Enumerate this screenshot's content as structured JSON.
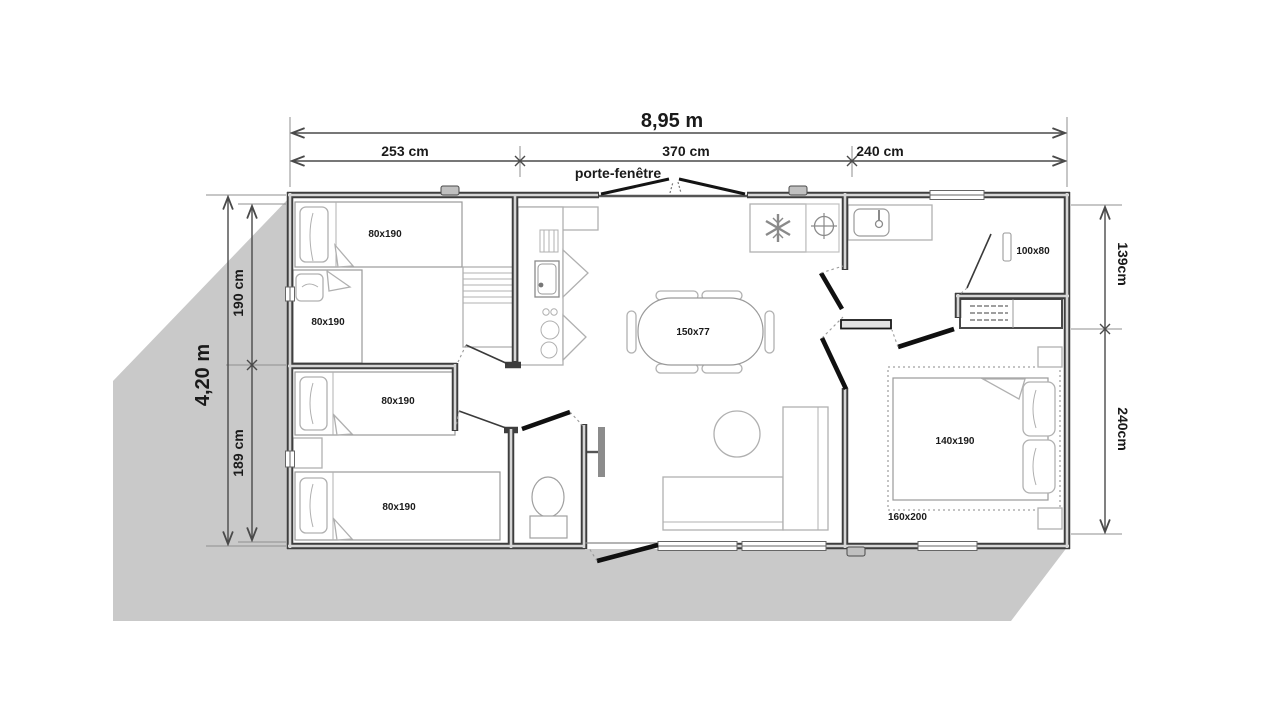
{
  "dimensions": {
    "total_width": "8,95 m",
    "top_segments": [
      "253 cm",
      "370 cm",
      "240 cm"
    ],
    "door_label": "porte-fenêtre",
    "total_depth": "4,20 m",
    "left_segments": [
      "190 cm",
      "189 cm"
    ],
    "right_segments": [
      "139cm",
      "240cm"
    ]
  },
  "rooms": {
    "bed_labels": [
      "80x190",
      "80x190",
      "80x190",
      "80x190"
    ],
    "dining_table": "150x77",
    "shower": "100x80",
    "double_bed": "140x190",
    "double_bed_zone": "160x200"
  },
  "colors": {
    "shadow": "#c9c9c9",
    "wall": "#3e3e3e",
    "wall_core": "#d6d6d6",
    "furniture_line": "#b0b0b0",
    "door": "#101010",
    "text": "#1a1a1a"
  }
}
